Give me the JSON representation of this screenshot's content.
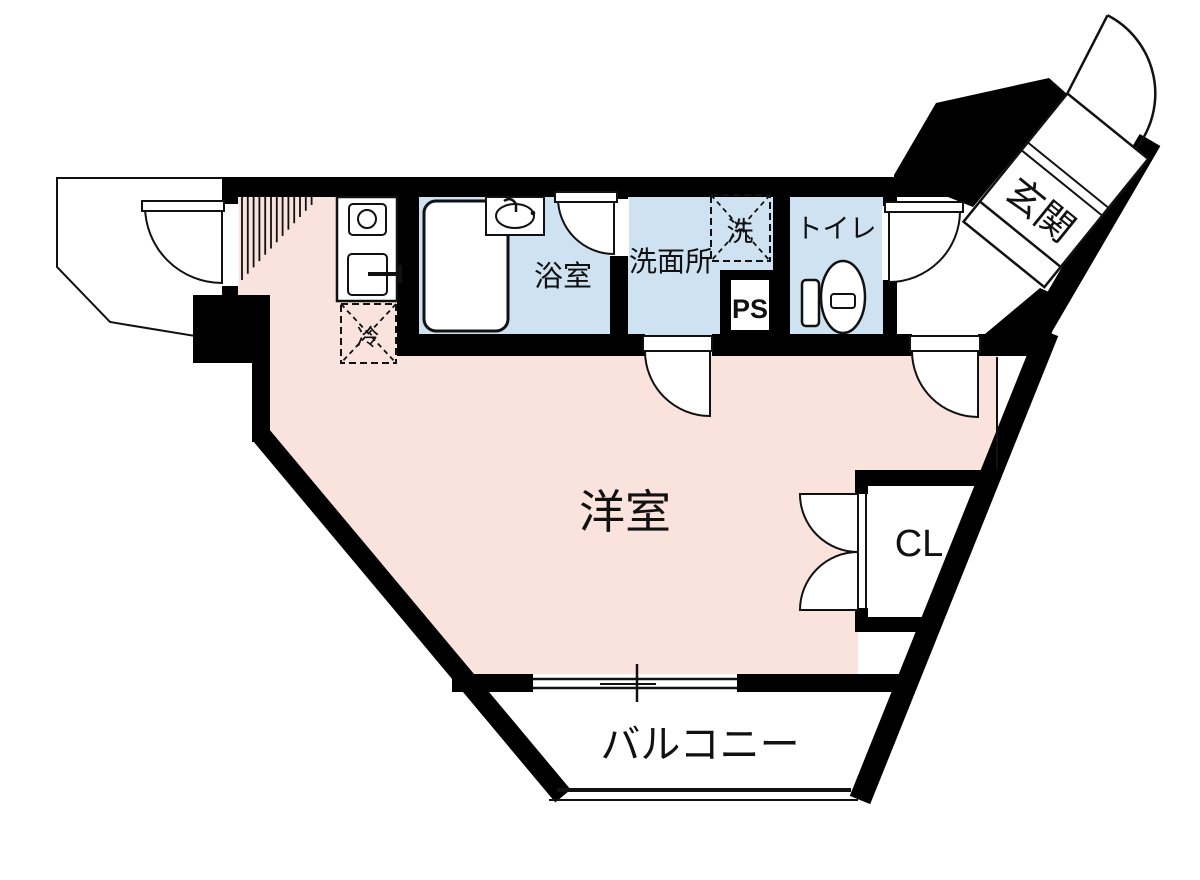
{
  "plan": {
    "type": "apartment-floor-plan",
    "rooms": {
      "living": {
        "label": "洋室"
      },
      "bath": {
        "label": "浴室"
      },
      "washroom": {
        "label": "洗面所"
      },
      "toilet": {
        "label": "トイレ"
      },
      "entrance": {
        "label": "玄関"
      },
      "balcony": {
        "label": "バルコニー"
      },
      "closet": {
        "label": "CL"
      },
      "pipe_space": {
        "label": "PS"
      },
      "washer": {
        "label": "洗"
      },
      "refrigerator": {
        "label": "冷"
      }
    },
    "colors": {
      "room_fill": "#fae3dd",
      "wet_fill": "#cfe2f1",
      "wall": "#000000",
      "line": "#111111",
      "background": "#ffffff"
    }
  }
}
